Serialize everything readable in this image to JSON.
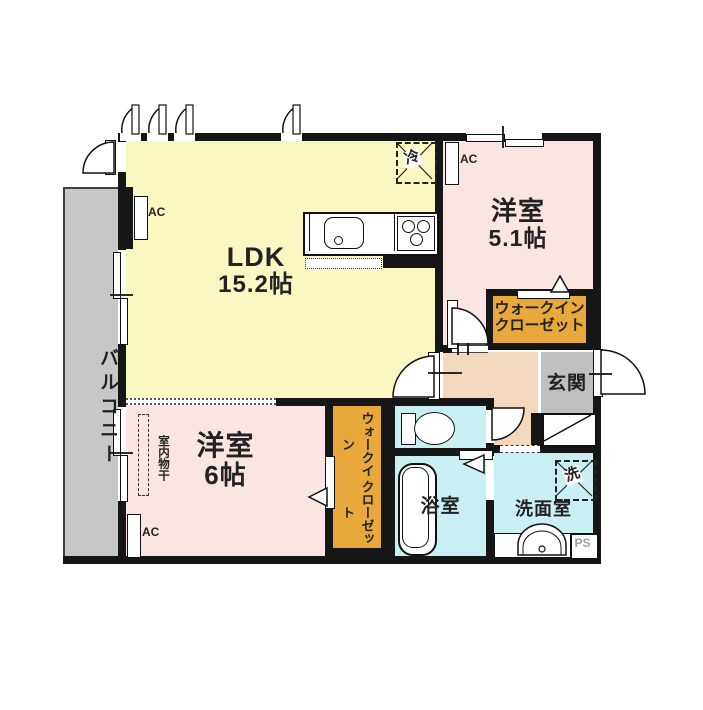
{
  "rooms": {
    "ldk": {
      "name": "LDK",
      "size": "15.2帖"
    },
    "bedroom_a": {
      "name": "洋室",
      "size": "5.1帖"
    },
    "bedroom_b": {
      "name": "洋室",
      "size": "6帖"
    },
    "balcony": {
      "name": "バルコニー"
    },
    "walkin_closet_a": {
      "line1": "ウォークイン",
      "line2": "クローゼット"
    },
    "walkin_closet_b": {
      "line1": "ウォークイン",
      "line2": "クローゼット"
    },
    "entrance": {
      "name": "玄関"
    },
    "bathroom": {
      "name": "浴室"
    },
    "washroom": {
      "name": "洗面室"
    }
  },
  "fixtures": {
    "ac_label": "AC",
    "refrigerator": "冷",
    "washer": "洗",
    "pipe_space": "PS",
    "indoor_drying": "室内物干"
  },
  "colors": {
    "wall": "#161616",
    "ldk": "#FAF7C3",
    "bedroom": "#FBE5E2",
    "closet": "#E9A83C",
    "wet": "#C9EFF2",
    "hall": "#F3D8BD",
    "balcony": "#C7C7C7",
    "entrance_floor": "#BFBFBF"
  }
}
